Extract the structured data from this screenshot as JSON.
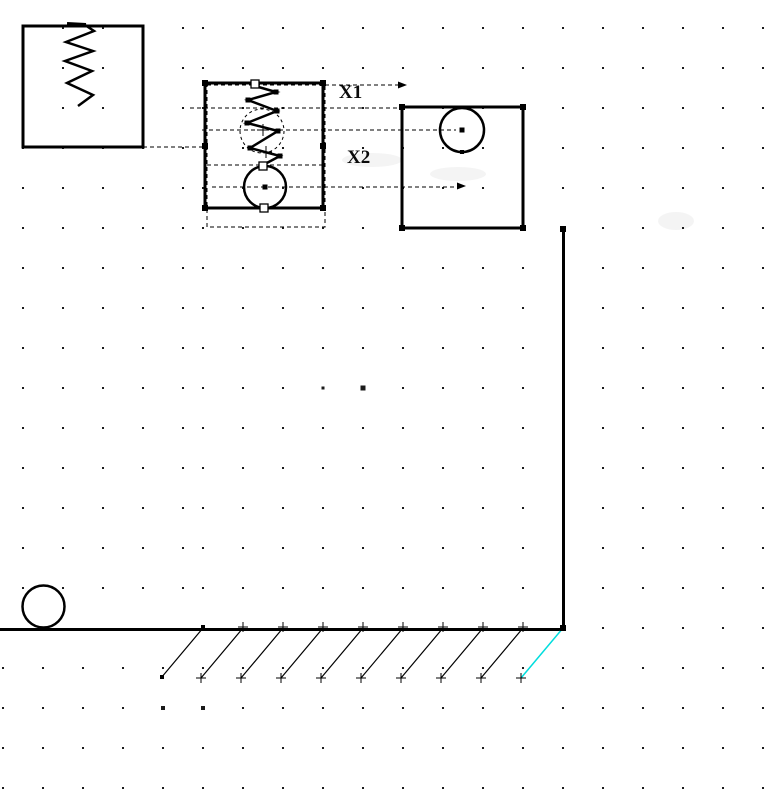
{
  "canvas": {
    "width": 781,
    "height": 790,
    "background": "#ffffff"
  },
  "labels": {
    "x1": "X1",
    "x2": "X2"
  },
  "colors": {
    "ink": "#000000",
    "grid_dot": "#1b1b1b",
    "highlight": "#00dddd",
    "smudge": "rgba(0,0,0,0.045)"
  },
  "grid": {
    "spacing": 40,
    "row_start": 28,
    "row_count": 20,
    "dot_size": 2,
    "upper_left_cols": [
      23,
      63,
      103,
      143,
      183
    ],
    "upper_col_start": 203,
    "ground_row_index": 15,
    "ground_row_col_start": 603,
    "lower_col_start": 3,
    "col_max": 763,
    "bold_dots": [
      [
        323,
        388,
        3
      ],
      [
        363,
        388,
        5
      ],
      [
        163,
        708,
        4
      ],
      [
        203,
        708,
        4
      ]
    ]
  },
  "figure": {
    "boxes": [
      {
        "name": "left-anchor-box",
        "x": 23,
        "y": 26,
        "w": 120,
        "h": 121
      },
      {
        "name": "selected-assembly-box",
        "x": 205,
        "y": 83,
        "w": 118,
        "h": 125
      },
      {
        "name": "right-mass-box",
        "x": 402,
        "y": 107,
        "w": 121,
        "h": 121
      }
    ],
    "selection_rect": {
      "x": 207,
      "y": 85,
      "w": 118,
      "h": 142
    },
    "anchor_bar": {
      "x1": 67,
      "y1": 24,
      "x2": 86,
      "y2": 25
    },
    "left_spring": [
      [
        85,
        25
      ],
      [
        94,
        31
      ],
      [
        66,
        42
      ],
      [
        93,
        51
      ],
      [
        65,
        61
      ],
      [
        92,
        71
      ],
      [
        67,
        83
      ],
      [
        93,
        95
      ],
      [
        78,
        106
      ]
    ],
    "middle_spring": [
      [
        255,
        86
      ],
      [
        276,
        92
      ],
      [
        248,
        100
      ],
      [
        277,
        111
      ],
      [
        247,
        123
      ],
      [
        278,
        131
      ],
      [
        250,
        148
      ],
      [
        280,
        156
      ],
      [
        263,
        165
      ]
    ],
    "spring_vertex_dots": [
      [
        276,
        92
      ],
      [
        248,
        100
      ],
      [
        277,
        111
      ],
      [
        247,
        123
      ],
      [
        278,
        131
      ],
      [
        250,
        148
      ],
      [
        280,
        156
      ]
    ],
    "circles": [
      {
        "name": "middle-mass-circle",
        "cx": 265,
        "cy": 187,
        "r": 21
      },
      {
        "name": "right-mass-circle",
        "cx": 462,
        "cy": 130,
        "r": 22
      },
      {
        "name": "rolling-ball",
        "cx": 43.5,
        "cy": 606.5,
        "r": 21
      }
    ],
    "ghost_circle": {
      "cx": 262,
      "cy": 131,
      "r": 22
    },
    "crosses": [
      [
        263,
        130
      ],
      [
        266,
        152
      ]
    ],
    "dash_lines": [
      {
        "name": "connector-left-box",
        "x1": 143,
        "y1": 147,
        "x2": 205,
        "y2": 147
      },
      {
        "name": "dim-line-top-edge",
        "x1": 190,
        "y1": 108,
        "x2": 402,
        "y2": 108
      },
      {
        "name": "dim-line-circle-center",
        "x1": 202,
        "y1": 130,
        "x2": 456,
        "y2": 130
      },
      {
        "name": "dim-line-junction",
        "x1": 207,
        "y1": 165,
        "x2": 325,
        "y2": 165
      },
      {
        "name": "dim-line-x2",
        "x1": 212,
        "y1": 187,
        "x2": 457,
        "y2": 187
      },
      {
        "name": "dim-line-x1",
        "x1": 325,
        "y1": 85,
        "x2": 401,
        "y2": 85
      }
    ],
    "arrows": [
      {
        "name": "arrowhead-x1",
        "tipx": 407,
        "tipy": 85
      },
      {
        "name": "arrowhead-x2",
        "tipx": 466,
        "tipy": 186
      }
    ],
    "handles_filled": [
      [
        205,
        83
      ],
      [
        323,
        83
      ],
      [
        205,
        208
      ],
      [
        323,
        208
      ],
      [
        205,
        146
      ],
      [
        323,
        146
      ],
      [
        402,
        107
      ],
      [
        523,
        107
      ],
      [
        402,
        228
      ],
      [
        523,
        228
      ],
      [
        563,
        229
      ],
      [
        563,
        628
      ]
    ],
    "handles_open": [
      [
        255,
        84
      ],
      [
        263,
        166
      ],
      [
        264,
        208
      ]
    ],
    "center_dots": [
      [
        265,
        187
      ],
      [
        462,
        130
      ]
    ],
    "small_dots": [
      [
        462,
        152
      ],
      [
        203,
        627
      ],
      [
        162,
        677
      ]
    ],
    "wall": {
      "x": 563.5,
      "y1": 228,
      "y2": 629
    },
    "ground": {
      "x1": 0,
      "x2": 565,
      "y": 629.5
    },
    "hatching": {
      "count": 9,
      "x_start": 203,
      "x_step": 40,
      "dx": -42,
      "dy": 50,
      "y": 628,
      "plus_arm": 5
    },
    "cyan_hatch": {
      "x1": 563,
      "y1": 628,
      "x2": 521,
      "y2": 678
    },
    "smudges": [
      [
        458,
        174,
        28,
        7
      ],
      [
        676,
        221,
        18,
        9
      ],
      [
        372,
        160,
        30,
        7
      ]
    ],
    "label_pos": {
      "x1": [
        339,
        98
      ],
      "x2": [
        347,
        163
      ]
    }
  }
}
